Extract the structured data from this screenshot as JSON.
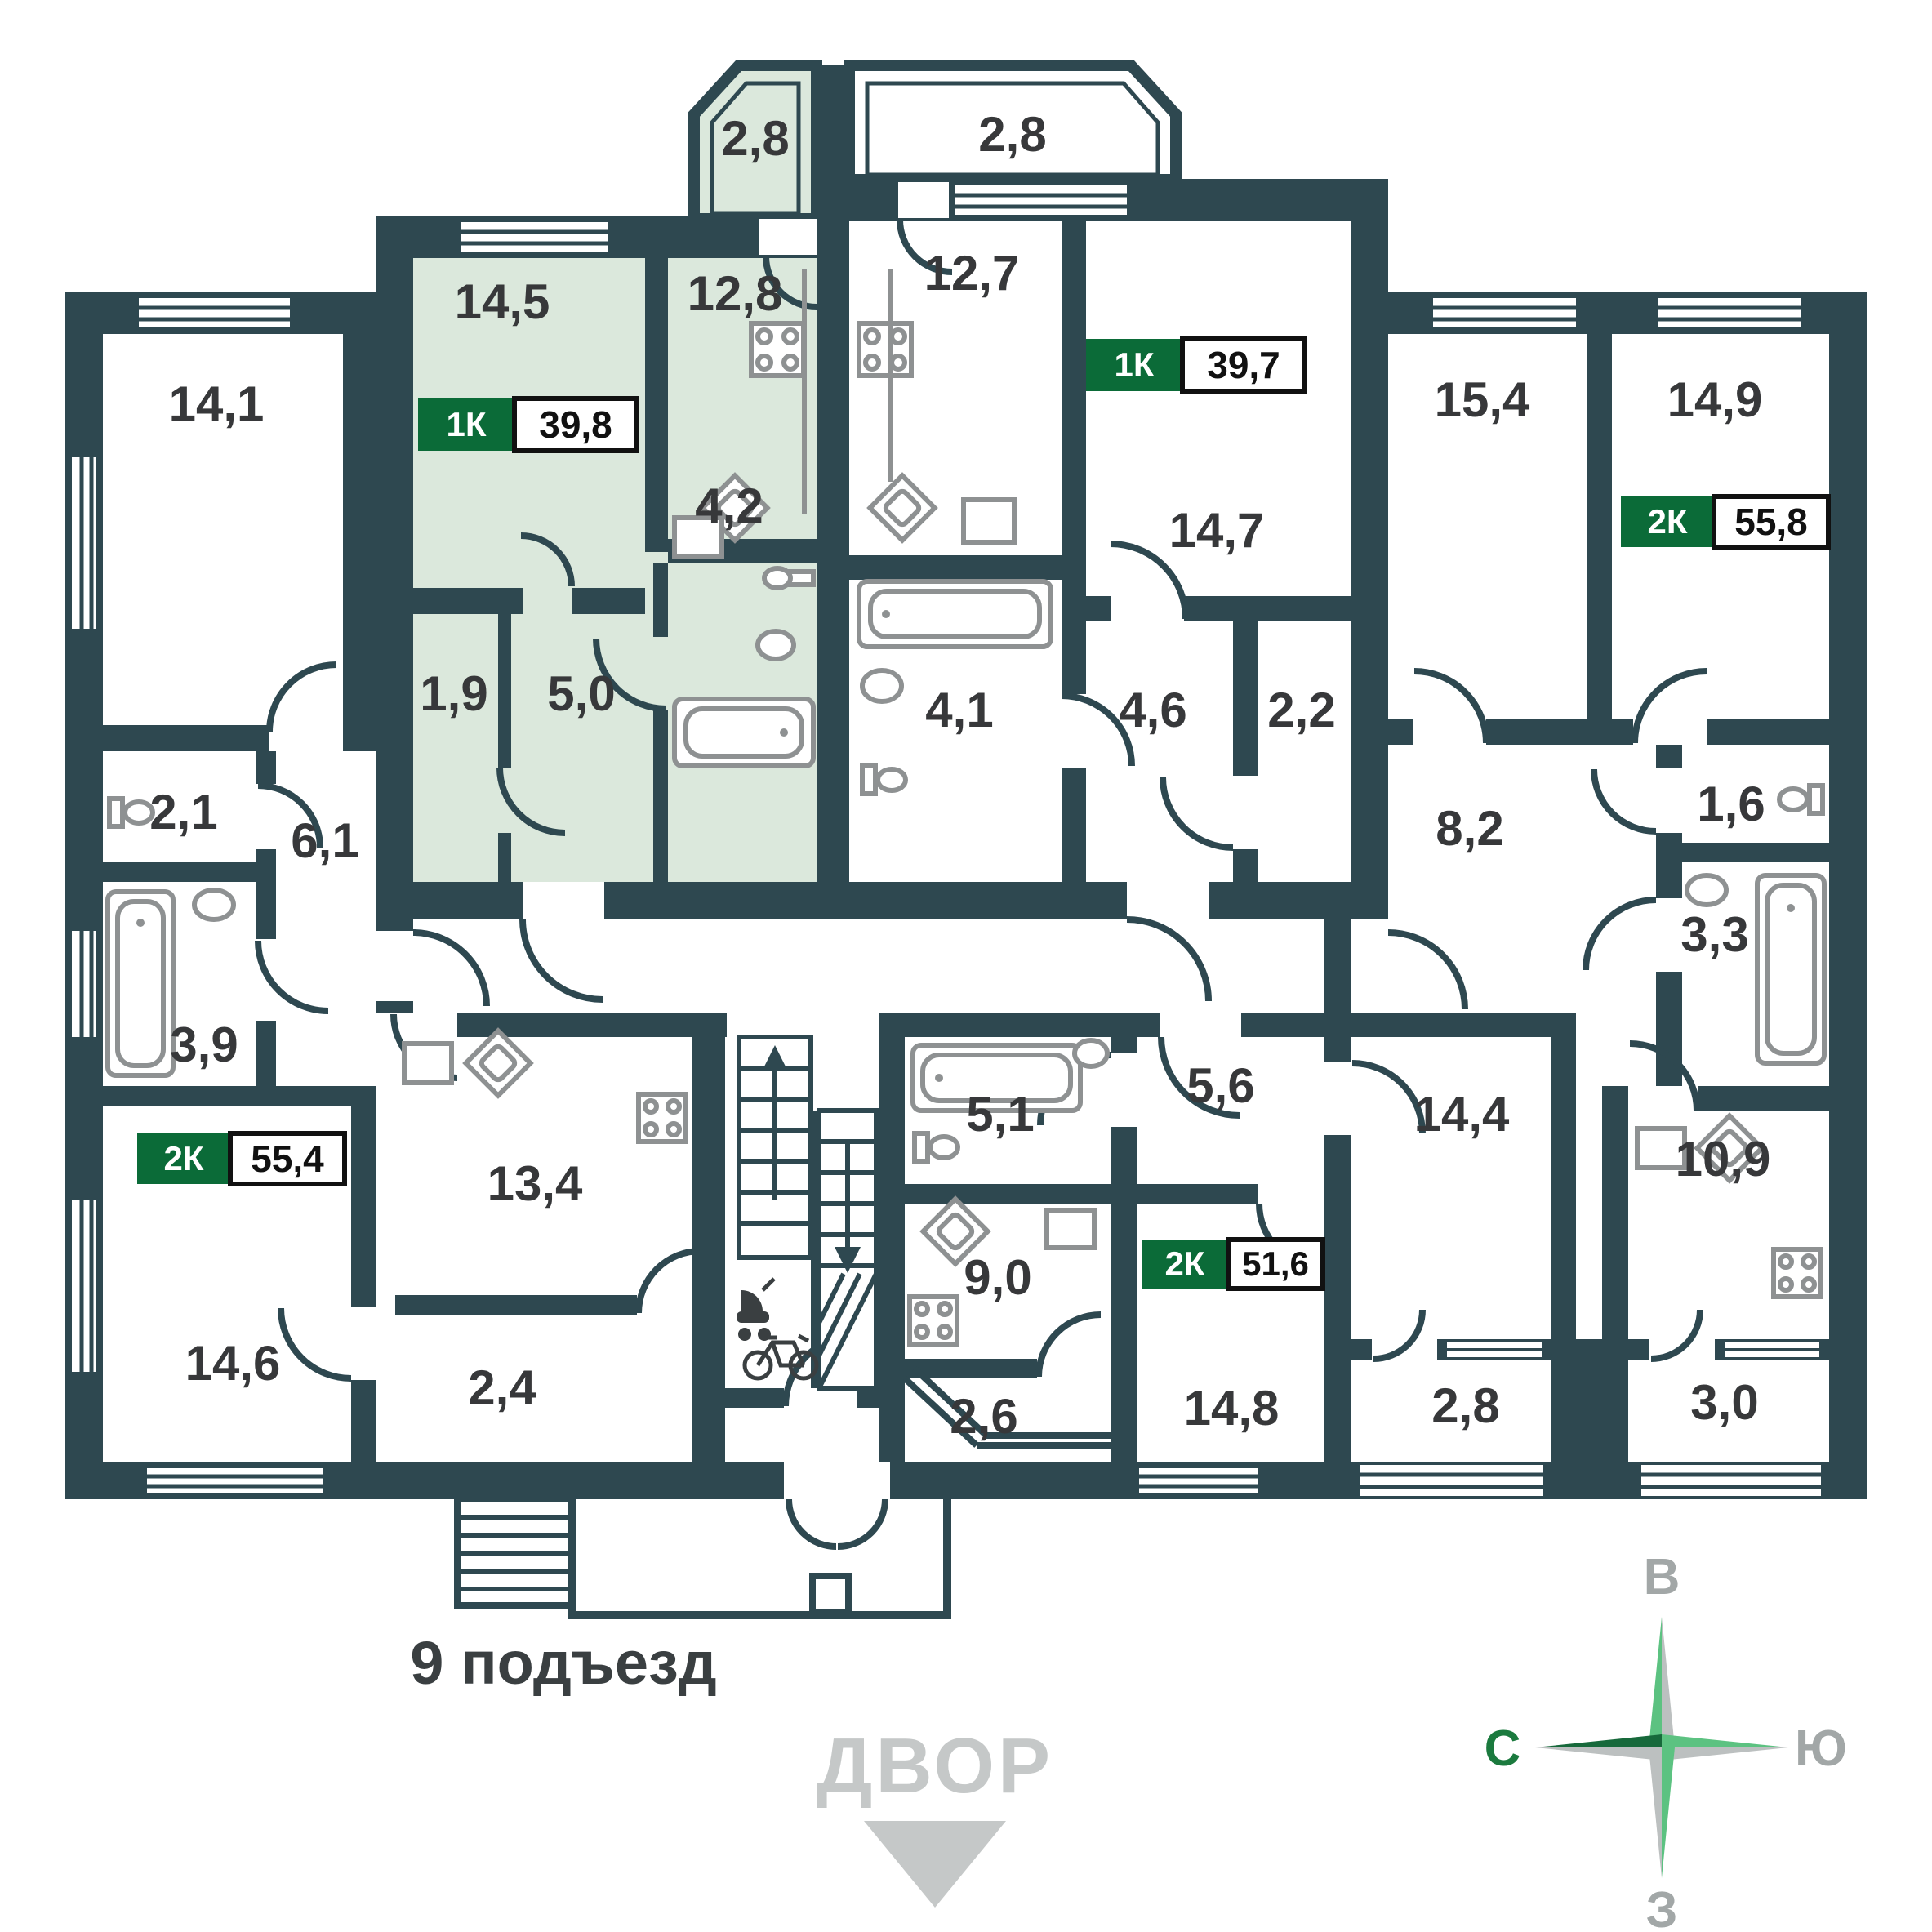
{
  "colors": {
    "wall": "#2E4850",
    "highlight": "#DBE8DC",
    "badge_green": "#0B6B38",
    "fixture_gray": "#8E9192",
    "label_dark": "#37383A",
    "muted_gray": "#C5C8C8",
    "compass_light_green": "#5CC281",
    "compass_dark_green": "#17693B"
  },
  "entrance": {
    "label": "9 подъезд"
  },
  "courtyard": {
    "label": "ДВОР"
  },
  "compass": {
    "top": "В",
    "left": "С",
    "right": "Ю",
    "bottom": "З"
  },
  "apartments": {
    "green": {
      "type": "1К",
      "area": "39,8",
      "highlighted": true
    },
    "center": {
      "type": "1К",
      "area": "39,7",
      "highlighted": false
    },
    "right": {
      "type": "2К",
      "area": "55,8",
      "highlighted": false
    },
    "left": {
      "type": "2К",
      "area": "55,4",
      "highlighted": false
    },
    "bottom": {
      "type": "2К",
      "area": "51,6",
      "highlighted": false
    }
  },
  "rooms": {
    "r14_1": "14,1",
    "g_room": "14,5",
    "g_kitchen": "12,8",
    "g_balcony": "2,8",
    "g_bath": "4,2",
    "g_small": "1,9",
    "g_hall": "5,0",
    "c_kitchen": "12,7",
    "c_balcony": "2,8",
    "c_room": "14,7",
    "c_bath": "4,1",
    "c_hall": "4,6",
    "c_ward": "2,2",
    "rt_room1": "15,4",
    "rt_room2": "14,9",
    "rt_hall": "8,2",
    "rt_wc": "1,6",
    "rt_bath": "3,3",
    "rt_kitchen": "10,9",
    "rt_loggia": "3,0",
    "lf_wc": "2,1",
    "lf_hall": "6,1",
    "lf_bath": "3,9",
    "lf_kitchen": "13,4",
    "lf_room2": "14,6",
    "lf_entry": "2,4",
    "b_bath": "5,1",
    "b_hall": "5,6",
    "b_kitchen": "9,0",
    "b_entry": "2,6",
    "b_room1": "14,8",
    "b_room2": "14,4",
    "b_loggia": "2,8"
  }
}
